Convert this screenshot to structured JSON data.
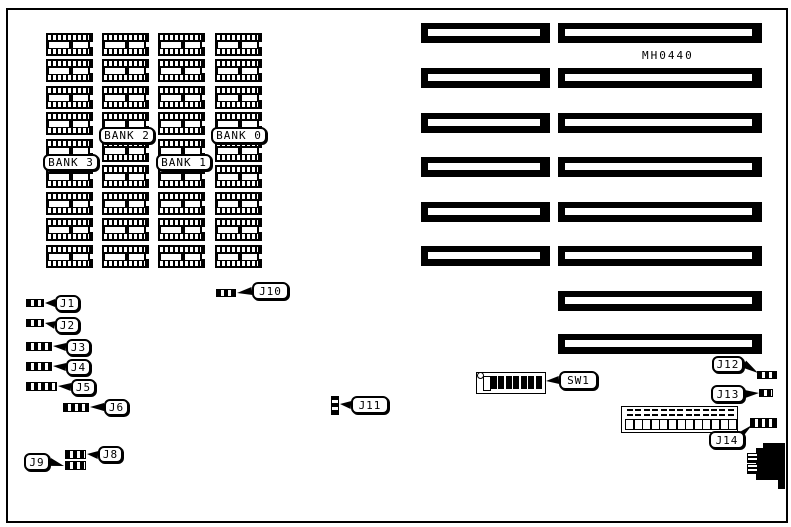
{
  "board": {
    "part_number": "MH0440",
    "banks": [
      {
        "id": "bank3",
        "label": "BANK 3"
      },
      {
        "id": "bank2",
        "label": "BANK 2"
      },
      {
        "id": "bank1",
        "label": "BANK 1"
      },
      {
        "id": "bank0",
        "label": "BANK 0"
      }
    ],
    "callouts": [
      {
        "id": "j1",
        "label": "J1"
      },
      {
        "id": "j2",
        "label": "J2"
      },
      {
        "id": "j3",
        "label": "J3"
      },
      {
        "id": "j4",
        "label": "J4"
      },
      {
        "id": "j5",
        "label": "J5"
      },
      {
        "id": "j6",
        "label": "J6"
      },
      {
        "id": "j8",
        "label": "J8"
      },
      {
        "id": "j9",
        "label": "J9"
      },
      {
        "id": "j10",
        "label": "J10"
      },
      {
        "id": "j11",
        "label": "J11"
      },
      {
        "id": "j12",
        "label": "J12"
      },
      {
        "id": "j13",
        "label": "J13"
      },
      {
        "id": "j14",
        "label": "J14"
      },
      {
        "id": "sw1",
        "label": "SW1"
      }
    ],
    "dip_switch": {
      "label": "SW1",
      "positions": 8,
      "states": [
        "open",
        "closed",
        "closed",
        "closed",
        "closed",
        "closed",
        "closed",
        "closed"
      ]
    },
    "memory": {
      "bank_columns": 4,
      "chips_per_column": 9
    },
    "expansion_slots": {
      "left_column_count": 6,
      "right_column_count": 8
    },
    "power_connector": {
      "pin_count": 13
    },
    "colors": {
      "ink": "#000000",
      "background": "#ffffff"
    }
  }
}
